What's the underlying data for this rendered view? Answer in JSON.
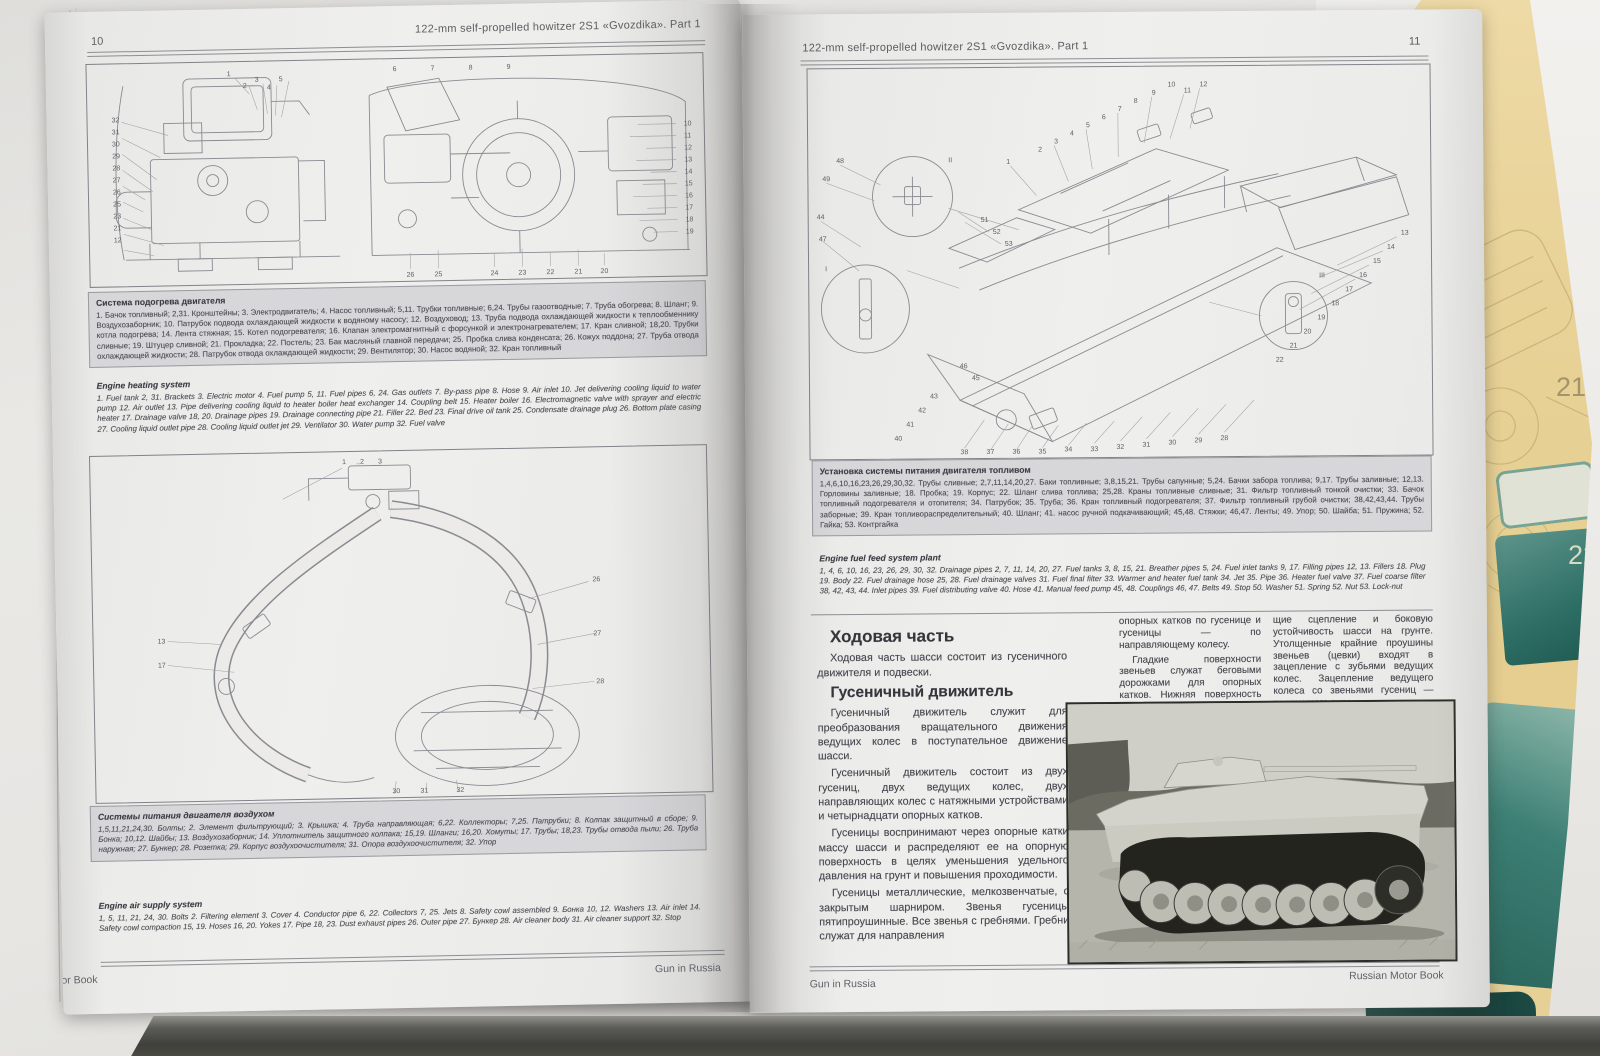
{
  "book": {
    "left_page": {
      "page_number": "10",
      "header_title": "122-mm self-propelled howitzer 2S1 «Gvozdika». Part 1",
      "footer_left": "Russian Motor Book",
      "footer_right": "Gun in Russia",
      "captions": {
        "heating_ru_title": "Система подогрева двигателя",
        "heating_ru_body": "1. Бачок топливный; 2,31. Кронштейны; 3. Электродвигатель; 4. Насос топливный; 5,11. Трубки топливные; 6,24. Трубы газоотводные; 7. Труба обогрева; 8. Шланг; 9. Воздухозаборник; 10. Патрубок подвода охлаждающей жидкости к водяному насосу; 12. Воздуховод; 13. Труба подвода охлаждающей жидкости к теплообменнику котла подогрева; 14. Лента стяжная; 15. Котел подогревателя; 16. Клапан электромагнитный с форсункой и электронагревателем; 17. Кран сливной; 18,20. Трубки сливные; 19. Штуцер сливной; 21. Прокладка; 22. Постель; 23. Бак масляный главной передачи; 25. Пробка слива конденсата; 26. Кожух поддона; 27. Труба отвода охлаждающей жидкости; 28. Патрубок отвода охлаждающей жидкости; 29. Вентилятор; 30. Насос водяной; 32. Кран топливный",
        "heating_en_title": "Engine heating system",
        "heating_en_body": "1. Fuel tank 2, 31. Brackets 3. Electric motor 4. Fuel pump 5, 11. Fuel pipes 6, 24. Gas outlets 7. By-pass pipe 8. Hose 9. Air inlet 10. Jet delivering cooling liquid to water pump 12. Air outlet 13. Pipe delivering cooling liquid to heater boiler heat exchanger 14. Coupling belt 15. Heater boiler 16. Electromagnetic valve with sprayer and electric heater 17. Drainage valve 18, 20. Drainage pipes 19. Drainage connecting pipe 21. Filler 22. Bed 23. Final drive oil tank 25. Condensate drainage plug 26. Bottom plate casing 27. Cooling liquid outlet pipe 28. Cooling liquid outlet jet 29. Ventilator 30. Water pump 32. Fuel valve",
        "air_ru_title": "Системы питания двигателя воздухом",
        "air_ru_body": "1,5,11,21,24,30. Болты; 2. Элемент фильтрующий; 3. Крышка; 4. Труба направляющая; 6,22. Коллекторы; 7,25. Патрубки; 8. Колпак защитный в сборе; 9. Бонка; 10,12. Шайбы; 13. Воздухозаборник; 14. Уплотнитель защитного колпака; 15,19. Шланги; 16,20. Хомуты; 17. Трубы; 18,23. Трубы отвода пыли; 26. Труба наружная; 27. Бункер; 28. Розетка; 29. Корпус воздухоочистителя; 31. Опора воздухоочистителя; 32. Упор",
        "air_en_title": "Engine air supply system",
        "air_en_body": "1, 5, 11, 21, 24, 30. Bolts 2. Filtering element 3. Cover 4. Conductor pipe 6, 22. Collectors 7, 25. Jets 8. Safety cowl assembled 9. Бонка 10, 12. Washers 13. Air inlet 14. Safety cowl compaction 15, 19. Hoses 16, 20. Yokes 17. Pipe 18, 23. Dust exhaust pipes 26. Outer pipe 27. Бункер 28. Air cleaner body 31. Air cleaner support 32. Stop"
      }
    },
    "right_page": {
      "page_number": "11",
      "header_title": "122-mm self-propelled howitzer 2S1 «Gvozdika». Part 1",
      "footer_left": "Gun in Russia",
      "footer_right": "Russian Motor Book",
      "captions": {
        "fuel_ru_title": "Установка системы питания двигателя топливом",
        "fuel_ru_body": "1,4,6,10,16,23,26,29,30,32. Трубы сливные; 2,7,11,14,20,27. Баки топливные; 3,8,15,21. Трубы сапунные; 5,24. Бачки забора топлива; 9,17. Трубы заливные; 12,13. Горловины заливные; 18. Пробка; 19. Корпус; 22. Шланг слива топлива; 25,28. Краны топливные сливные; 31. Фильтр топливный тонкой очистки; 33. Бачок топливный подогревателя и отопителя; 34. Патрубок; 35. Труба; 36. Кран топливный подогревателя; 37. Фильтр топливный грубой очистки; 38,42,43,44. Трубы заборные; 39. Кран топливораспределительный; 40. Шланг; 41. насос ручной подкачивающий; 45,48. Стяжки; 46,47. Ленты; 49. Упор; 50. Шайба; 51. Пружина; 52. Гайка; 53. Контргайка",
        "fuel_en_title": "Engine fuel feed system plant",
        "fuel_en_body": "1, 4, 6, 10, 16, 23, 26, 29, 30, 32. Drainage pipes 2, 7, 11, 14, 20, 27. Fuel tanks 3, 8, 15, 21. Breather pipes 5, 24. Fuel inlet tanks 9, 17. Filling pipes 12, 13. Fillers 18. Plug 19. Body 22. Fuel drainage hose 25, 28. Fuel drainage valves 31. Fuel final filter 33. Warmer and heater fuel tank 34. Jet 35. Pipe 36. Heater fuel valve 37. Fuel coarse filter 38, 42, 43, 44. Inlet pipes 39. Fuel distributing valve 40. Hose 41. Manual feed pump 45, 48. Couplings 46, 47. Belts 49. Stop 50. Washer 51. Spring 52. Nut 53. Lock-nut"
      },
      "sections": {
        "running_gear_title": "Ходовая часть",
        "running_gear_p1": "Ходовая часть шасси состоит из гусеничного движителя и подвески.",
        "track_unit_title": "Гусеничный движитель",
        "track_unit_p1": "Гусеничный движитель служит для преобразования вращательного движения ведущих колес в поступательное движение шасси.",
        "track_unit_p2": "Гусеничный движитель состоит из двух гусениц, двух ведущих колес, двух направляющих колес с натяжными устройствами и четырнадцати опорных катков.",
        "track_unit_p3": "Гусеницы воспринимают через опорные катки массу шасси и распределяют ее на опорную поверхность в целях уменьшения удельного давления на грунт и повышения проходимости.",
        "track_unit_p4": "Гусеницы металлические, мелкозвенчатые, с закрытым шарниром. Звенья гусеницы пятипроушинные. Все звенья с гребнями. Гребни служат для направления",
        "col2_p1": "опорных катков по гусенице и гусеницы — по направляющему колесу.",
        "col2_p2": "Гладкие поверхности звеньев служат беговыми дорожками для опорных катков. Нижняя поверхность звеньев имеет грунтозацепы шевронного типа, обеспечиваю-",
        "col3_p1": "щие сцепление и боковую устойчивость шасси на грунте. Утолщенные крайние проушины звеньев (цевки) входят в зацепление с зубьями ведущих колес. Зацепление ведущего колеса со звеньями гусениц — толкающего типа."
      }
    },
    "side_page": {
      "cover_fragment": "on",
      "fig_number_21": "21",
      "fig_number_22": "22"
    }
  },
  "diagrams": {
    "engine_side": {
      "top": [
        "1",
        "2",
        "3",
        "4",
        "5"
      ],
      "left": [
        "32",
        "31",
        "30",
        "29",
        "28",
        "27",
        "26",
        "25",
        "23",
        "21",
        "12"
      ]
    },
    "engine_front": {
      "top": [
        "6",
        "7",
        "8",
        "9"
      ],
      "right": [
        "10",
        "11",
        "12",
        "13",
        "14",
        "15",
        "16",
        "17",
        "18",
        "19"
      ],
      "bottom": [
        "26",
        "25",
        "24",
        "23",
        "22",
        "21",
        "20"
      ]
    },
    "air_supply": {
      "top": [
        "1",
        "2",
        "3"
      ],
      "right": [
        "26",
        "27",
        "28"
      ],
      "left": [
        "13",
        "17"
      ],
      "bottom": [
        "30",
        "31",
        "32"
      ]
    },
    "fuel_system": {
      "top": [
        "12",
        "11",
        "10",
        "9",
        "8",
        "7",
        "6",
        "5",
        "4",
        "3",
        "2",
        "1"
      ],
      "right": [
        "13",
        "14",
        "15",
        "16",
        "17",
        "18",
        "19",
        "20",
        "21",
        "22"
      ],
      "bottom": [
        "38",
        "37",
        "36",
        "35",
        "34",
        "33",
        "32",
        "31",
        "30",
        "29",
        "28"
      ],
      "left": [
        "48",
        "49",
        "44",
        "47",
        "53",
        "52",
        "51",
        "46",
        "45",
        "43",
        "42",
        "41",
        "40"
      ],
      "details": [
        "I",
        "II",
        "III"
      ]
    }
  }
}
